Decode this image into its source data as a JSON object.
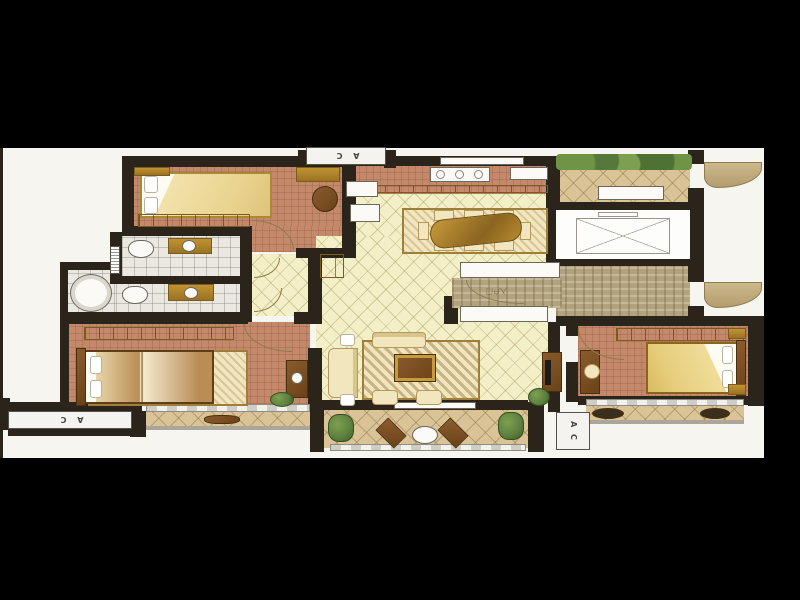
{
  "plan": {
    "labels": {
      "ac_top": "A C",
      "ac_left": "A C",
      "ac_right": "A C",
      "entry_door": "入户门"
    },
    "colors": {
      "backdrop": "#000000",
      "paper": "#f7f5f0",
      "wall": "#2b241b",
      "terra": "#c4886a",
      "tile": "#f3efc6",
      "tan": "#d9c397",
      "stone": "#b2a37e",
      "bath": "#eae8e0",
      "gold": "#c09232",
      "gold_dark": "#7c5c1e",
      "wood": "#8a5c2d",
      "cream": "#f2e6bf",
      "green": "#5c7f3e",
      "white_fix": "#fbfaf6"
    },
    "rooms": [
      {
        "id": "bedroom-top-left",
        "furniture": [
          "single-bed",
          "wardrobe",
          "console",
          "round-chair"
        ]
      },
      {
        "id": "bathroom-upper",
        "furniture": [
          "toilet",
          "vanity-sink"
        ]
      },
      {
        "id": "bathroom-lower",
        "furniture": [
          "toilet",
          "vanity-sink",
          "round-bathtub"
        ]
      },
      {
        "id": "master-bedroom",
        "furniture": [
          "double-bed",
          "wardrobe",
          "dresser",
          "plant",
          "bay-window"
        ]
      },
      {
        "id": "kitchen",
        "furniture": [
          "stove",
          "sink-counter",
          "fridge",
          "counter"
        ]
      },
      {
        "id": "dining-room",
        "furniture": [
          "dining-table",
          "chairs",
          "rug"
        ]
      },
      {
        "id": "living-room",
        "furniture": [
          "sofa",
          "loveseat",
          "armchairs",
          "coffee-table",
          "tv-cabinet",
          "plant",
          "rug"
        ]
      },
      {
        "id": "entry-garden",
        "furniture": [
          "planting",
          "bench",
          "entry-door"
        ]
      },
      {
        "id": "elevator",
        "furniture": [
          "elevator-car"
        ]
      },
      {
        "id": "entry-hall",
        "furniture": [
          "entry-door",
          "shafts"
        ]
      },
      {
        "id": "bedroom-right",
        "furniture": [
          "single-bed",
          "wardrobe",
          "desk",
          "nightstands",
          "bay-window"
        ]
      },
      {
        "id": "balcony",
        "furniture": [
          "bistro-table",
          "chairs",
          "plants",
          "railing"
        ]
      },
      {
        "id": "ac-platforms",
        "furniture": [
          "ac-platform-top",
          "ac-platform-left",
          "ac-platform-right"
        ]
      }
    ]
  }
}
